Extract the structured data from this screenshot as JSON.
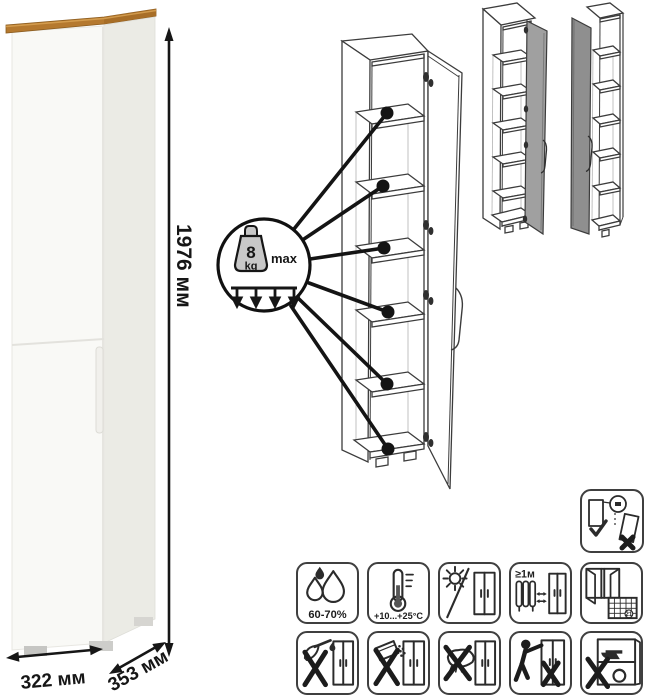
{
  "diagram_type": "furniture-product-diagram",
  "product": {
    "dimensions": {
      "height": "1976 мм",
      "width": "322 мм",
      "depth": "353 мм"
    },
    "shelf_load_badge": {
      "value": "8",
      "unit": "kg",
      "qualifier": "max"
    },
    "views": [
      "photo-front",
      "open-door-line-drawing",
      "door-hinged-right-variant",
      "door-hinged-left-variant"
    ]
  },
  "care_icons": {
    "humidity_label": "60-70%",
    "temperature_label": "+10...+25°C",
    "heat_distance_label": "≥1м",
    "ventilation_calendar_day": "21",
    "names": [
      "wall-anchor-required-icon",
      "humidity-range-icon",
      "temperature-range-icon",
      "no-direct-sunlight-icon",
      "distance-from-heat-source-icon",
      "ventilate-room-icon",
      "no-sharp-objects-liquids-icon",
      "no-abrasive-powders-icon",
      "no-abrasive-sponges-icon",
      "do-not-drag-icon",
      "do-not-overload-icon"
    ]
  },
  "colors": {
    "wood_top": "#b5792f",
    "cabinet_front": "#f9f9f6",
    "cabinet_side": "#ebebe5",
    "line_art": "#3c3c3c",
    "door_gray_right_variant": "#a0a0a0",
    "door_gray_left_variant": "#8f8f8f",
    "annotation_black": "#161616"
  }
}
